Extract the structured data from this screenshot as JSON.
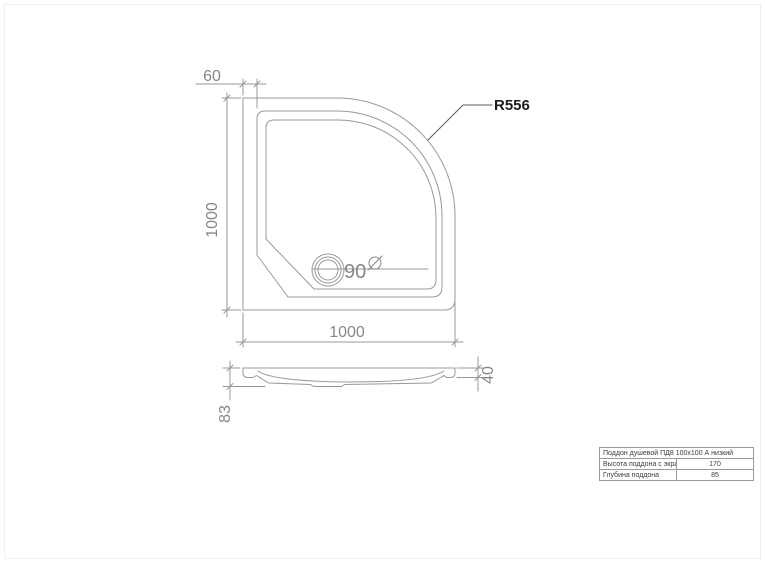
{
  "drawing_title": "Поддон душевой ПД8 100х100 А низкий",
  "top_view": {
    "width_dim": "1000",
    "height_dim": "1000",
    "rim_offset_dim": "60",
    "drain_diameter": "90",
    "diameter_symbol_icon": "⌀",
    "corner_radius_label": "R556"
  },
  "side_view": {
    "rim_height_dim": "40",
    "total_height_dim": "83"
  },
  "spec_table": {
    "title": "Поддон душевой ПД8 100х100 А низкий",
    "rows": [
      {
        "label": "Высота поддона с экраном",
        "value": "170"
      },
      {
        "label": "Глубина поддона",
        "value": "85"
      }
    ]
  },
  "colors": {
    "line": "#97989a",
    "dim_text": "#85878a",
    "radius_label": "#1c1c1c",
    "table_border": "#9a9a9a",
    "background": "#ffffff"
  }
}
